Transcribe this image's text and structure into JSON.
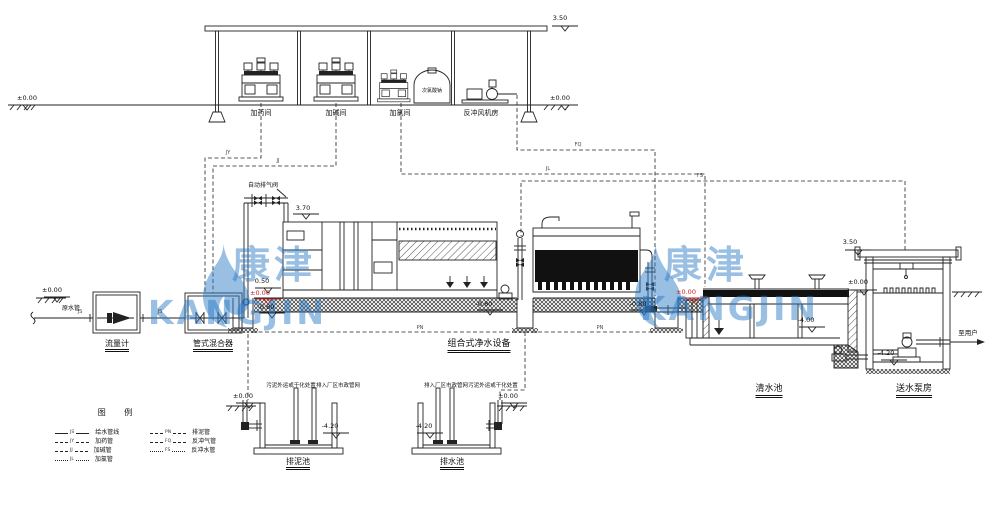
{
  "watermark": {
    "name_cn": "康津",
    "name_en": "KANGJIN"
  },
  "elevations": {
    "plus_000": "±0.00",
    "roof_350": "3.50",
    "pipe_370": "3.70",
    "inlet_050": "0.50",
    "minus_080": "-0.80",
    "tank_minus_400": "-4.00",
    "minus_420": "-4.20"
  },
  "dosing_area": {
    "room_labels": [
      "加药间",
      "加碱间",
      "加氯间",
      "反冲风机房"
    ],
    "hypochlorite_tank": "次氯酸钠"
  },
  "pretreatment": {
    "raw_water_pipe": "原水管",
    "flow_meter": "流量计",
    "pipe_mixer": "管式混合器"
  },
  "main_unit": {
    "label": "组合式净水设备",
    "air_release_valve": "自动排气阀"
  },
  "clear_water_tank": {
    "label": "清水池"
  },
  "pump_station": {
    "label": "送水泵房",
    "outlet": "至用户"
  },
  "pits": {
    "sludge_pit": "排泥池",
    "drain_pit": "排水池",
    "note_sludge_disposal": "污泥外运或干化处置",
    "note_municipal": "排入厂区市政管网"
  },
  "legend": {
    "title": "图 例",
    "left": [
      {
        "code": "JS",
        "label": "给水管线"
      },
      {
        "code": "JY",
        "label": "加药管"
      },
      {
        "code": "JJ",
        "label": "加碱管"
      },
      {
        "code": "JL",
        "label": "加氯管"
      }
    ],
    "right": [
      {
        "code": "PN",
        "label": "排泥管"
      },
      {
        "code": "FQ",
        "label": "反冲气管"
      },
      {
        "code": "FS",
        "label": "反冲水管"
      }
    ]
  },
  "pipe_codes": {
    "js": "JS",
    "jy": "JY",
    "jj": "JJ",
    "jl": "JL",
    "fq": "FQ",
    "fs": "FS",
    "pn": "PN"
  }
}
